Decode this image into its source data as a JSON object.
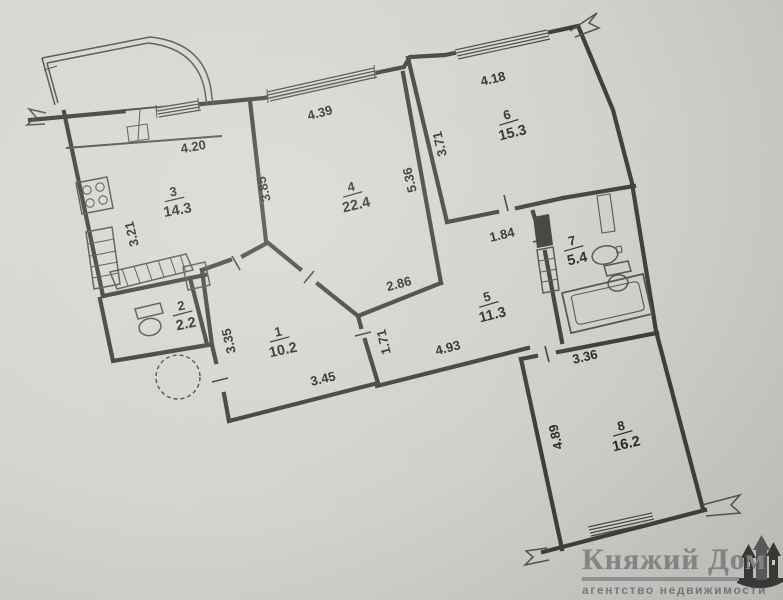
{
  "plan": {
    "ink_color": "#403e3a",
    "rooms": [
      {
        "id": "room-1",
        "number": "1",
        "area": "10.2"
      },
      {
        "id": "room-2",
        "number": "2",
        "area": "2.2"
      },
      {
        "id": "room-3",
        "number": "3",
        "area": "14.3"
      },
      {
        "id": "room-4",
        "number": "4",
        "area": "22.4"
      },
      {
        "id": "room-5",
        "number": "5",
        "area": "11.3"
      },
      {
        "id": "room-6",
        "number": "6",
        "area": "15.3"
      },
      {
        "id": "room-7",
        "number": "7",
        "area": "5.4"
      },
      {
        "id": "room-8",
        "number": "8",
        "area": "16.2"
      }
    ],
    "dimensions": [
      {
        "id": "dim-4-20",
        "value": "4.20"
      },
      {
        "id": "dim-4-39",
        "value": "4.39"
      },
      {
        "id": "dim-4-18",
        "value": "4.18"
      },
      {
        "id": "dim-3-21",
        "value": "3.21"
      },
      {
        "id": "dim-3-85",
        "value": "3.85"
      },
      {
        "id": "dim-5-36",
        "value": "5.36"
      },
      {
        "id": "dim-3-71",
        "value": "3.71"
      },
      {
        "id": "dim-1-84",
        "value": "1.84"
      },
      {
        "id": "dim-2-86",
        "value": "2.86"
      },
      {
        "id": "dim-3-35",
        "value": "3.35"
      },
      {
        "id": "dim-1-71",
        "value": "1.71"
      },
      {
        "id": "dim-4-93",
        "value": "4.93"
      },
      {
        "id": "dim-3-45",
        "value": "3.45"
      },
      {
        "id": "dim-3-36",
        "value": "3.36"
      },
      {
        "id": "dim-4-89",
        "value": "4.89"
      }
    ],
    "fixtures": [
      "stove-icon",
      "kitchen-counter-icon",
      "toilet-icon",
      "bathtub-icon",
      "sink-icon",
      "vent-shaft-icon",
      "garbage-chute-circle",
      "balcony-arc",
      "window-icon",
      "door-opening-icon",
      "wall-break-icon"
    ]
  },
  "watermark": {
    "title": "Княжий Дом",
    "subtitle": "агентство недвижимости",
    "title_color": "#8a8a8a",
    "icon": "castle-icon"
  }
}
